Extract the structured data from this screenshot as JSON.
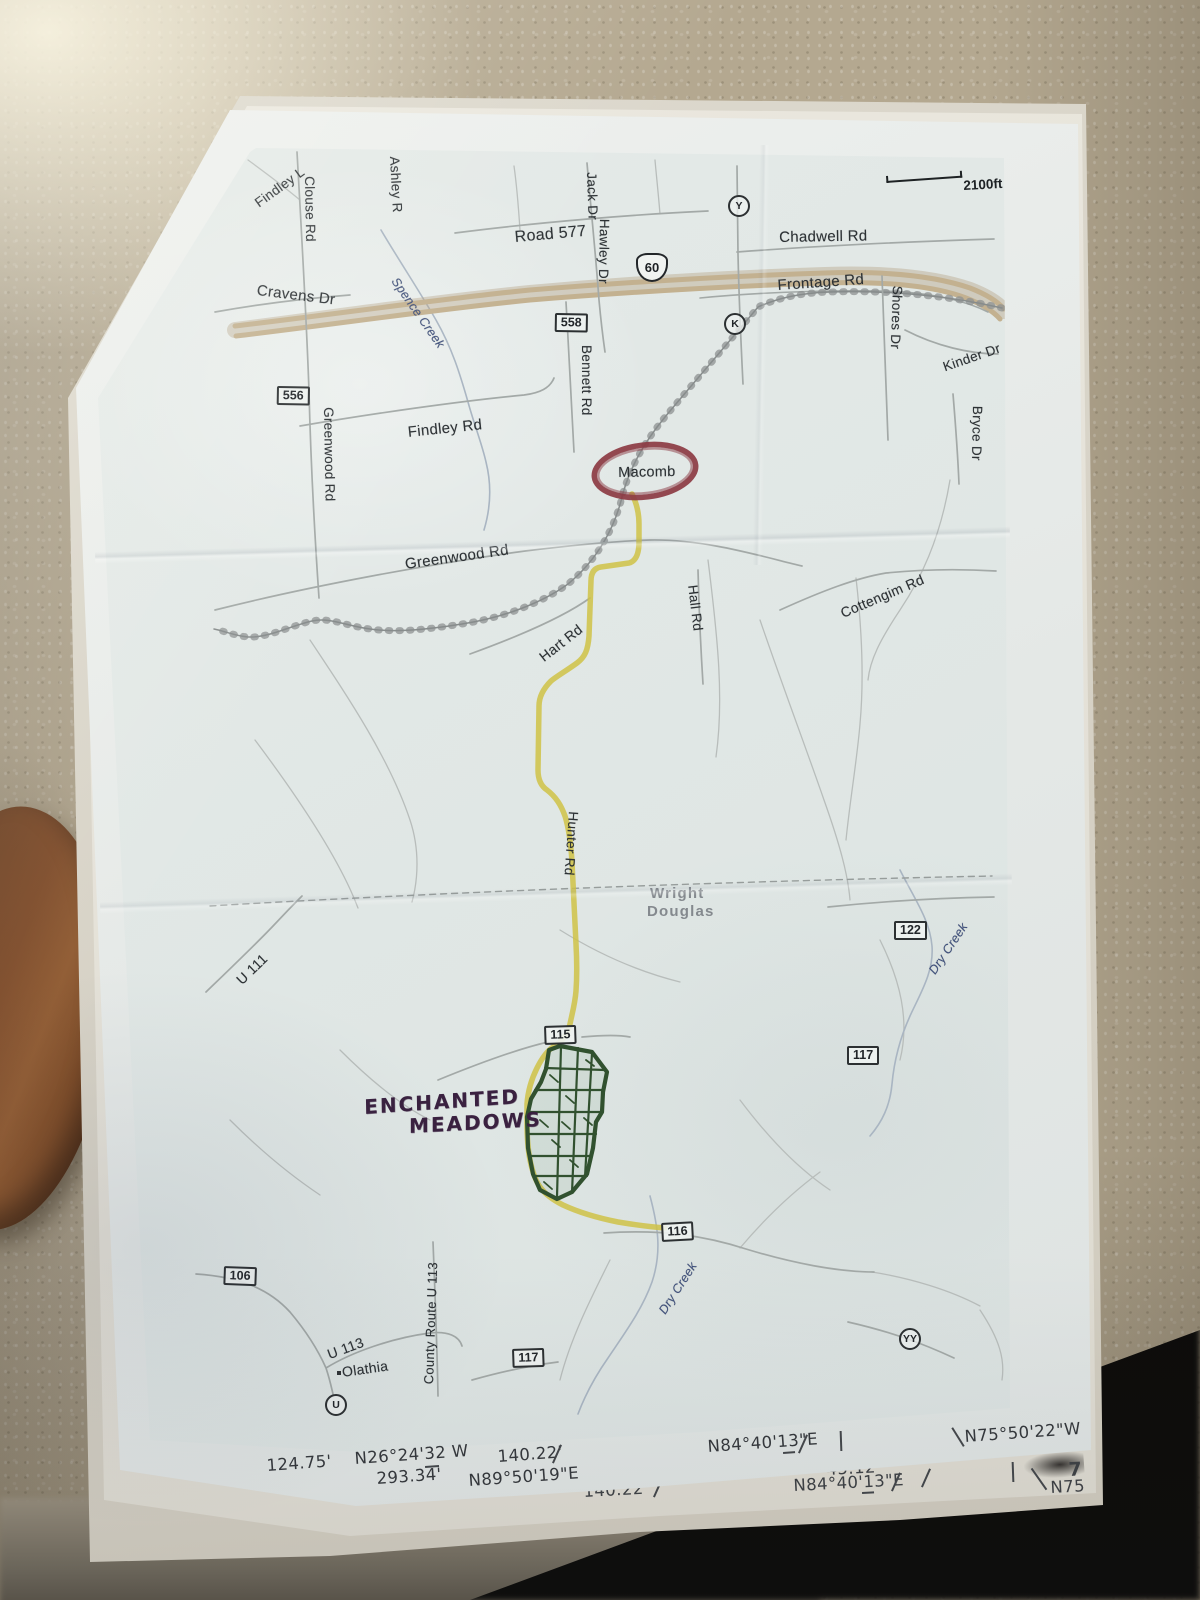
{
  "map": {
    "scale_label": "2100ft",
    "us_route_shield": "60",
    "road_labels": [
      {
        "id": "findley-partial",
        "text": "Findley L"
      },
      {
        "id": "clouse-rd",
        "text": "Clouse Rd"
      },
      {
        "id": "ashley-r",
        "text": "Ashley R"
      },
      {
        "id": "road-577",
        "text": "Road 577"
      },
      {
        "id": "jack-dr",
        "text": "Jack Dr"
      },
      {
        "id": "hawley-dr",
        "text": "Hawley Dr"
      },
      {
        "id": "chadwell-rd",
        "text": "Chadwell Rd"
      },
      {
        "id": "frontage-rd",
        "text": "Frontage Rd"
      },
      {
        "id": "cravens-dr",
        "text": "Cravens Dr"
      },
      {
        "id": "spence-creek",
        "text": "Spence Creek"
      },
      {
        "id": "shores-dr",
        "text": "Shores Dr"
      },
      {
        "id": "kinder-dr",
        "text": "Kinder Dr"
      },
      {
        "id": "bryce-dr",
        "text": "Bryce Dr"
      },
      {
        "id": "findley-rd",
        "text": "Findley Rd"
      },
      {
        "id": "greenwood-rd-vertical",
        "text": "Greenwood Rd"
      },
      {
        "id": "bennett-rd",
        "text": "Bennett Rd"
      },
      {
        "id": "greenwood-rd-horizontal",
        "text": "Greenwood Rd"
      },
      {
        "id": "macomb",
        "text": "Macomb"
      },
      {
        "id": "hart-rd",
        "text": "Hart Rd"
      },
      {
        "id": "hall-rd",
        "text": "Hall Rd"
      },
      {
        "id": "cottengim-rd",
        "text": "Cottengim Rd"
      },
      {
        "id": "hunter-rd",
        "text": "Hunter Rd"
      },
      {
        "id": "wright-county",
        "text": "Wright"
      },
      {
        "id": "douglas-county",
        "text": "Douglas"
      },
      {
        "id": "u-111",
        "text": "U 111"
      },
      {
        "id": "dry-creek-upper",
        "text": "Dry Creek"
      },
      {
        "id": "u-113",
        "text": "U 113"
      },
      {
        "id": "olathia",
        "text": "Olathia"
      },
      {
        "id": "county-route-u-113",
        "text": "County Route U 113"
      },
      {
        "id": "dry-creek-lower",
        "text": "Dry Creek"
      }
    ],
    "route_shields": [
      {
        "num": "556"
      },
      {
        "num": "558"
      },
      {
        "num": "122"
      },
      {
        "num": "117"
      },
      {
        "num": "115"
      },
      {
        "num": "116"
      },
      {
        "num": "106"
      },
      {
        "num": "117"
      }
    ],
    "circle_markers": [
      {
        "letter": "Y"
      },
      {
        "letter": "K"
      },
      {
        "letter": "YY"
      },
      {
        "letter": "U"
      }
    ],
    "handwriting": {
      "line1": "ENCHANTED",
      "line2": "MEADOWS"
    },
    "colors": {
      "highlight_route": "#cfc247",
      "circle_annotation": "#8c3a43",
      "subdivision_pen": "#31512f",
      "marker_ink": "#3a2140",
      "highway_fill": "#c3b190",
      "creek_label_ink": "#41527e"
    }
  },
  "survey_rows": {
    "row1": [
      "124.75'",
      "N26°24'32 W",
      "140.22'",
      "293.34'",
      "N89°50'19\"E",
      "N84°40'13\"E",
      "N75°50'22\"W"
    ],
    "row2": [
      "174.75'",
      "N26°24'32 W",
      "140.22'",
      "45.12",
      "N84°40'13\"E",
      "N75",
      "7"
    ]
  }
}
